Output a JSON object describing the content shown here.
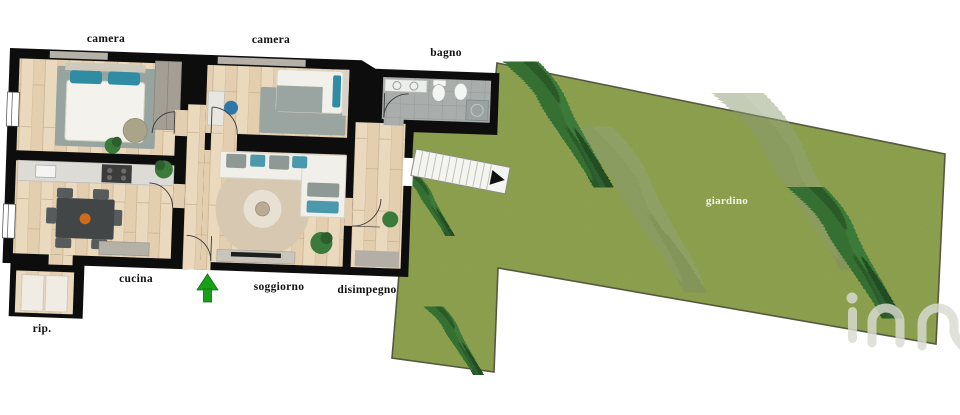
{
  "plan": {
    "type": "floor-plan-with-garden",
    "rooms": [
      {
        "id": "camera-1",
        "label": "camera"
      },
      {
        "id": "camera-2",
        "label": "camera"
      },
      {
        "id": "bagno",
        "label": "bagno"
      },
      {
        "id": "cucina",
        "label": "cucina"
      },
      {
        "id": "soggiorno",
        "label": "soggiorno"
      },
      {
        "id": "disimpegno",
        "label": "disimpegno"
      },
      {
        "id": "ripostiglio",
        "label": "rip."
      },
      {
        "id": "giardino",
        "label": "giardino"
      }
    ],
    "icons": {
      "entrance_arrow": "green-up-arrow",
      "stairs_arrow": "black-right-arrow",
      "watermark": "in-logo"
    },
    "colors": {
      "wall": "#0d0d0d",
      "wood_floor": "#e8d6ba",
      "tile_floor": "#a9aeac",
      "grass": "#8da14f",
      "tree_dark": "#31682f",
      "tree_faded": "#8a9a74",
      "rug_gray": "#9aa5a1",
      "round_rug": "#d7c8b2",
      "accent_teal": "#2f8ca3",
      "entrance_green": "#18a018",
      "stairs": "#f4f4f0",
      "watermark": "#d9dbd2"
    }
  }
}
